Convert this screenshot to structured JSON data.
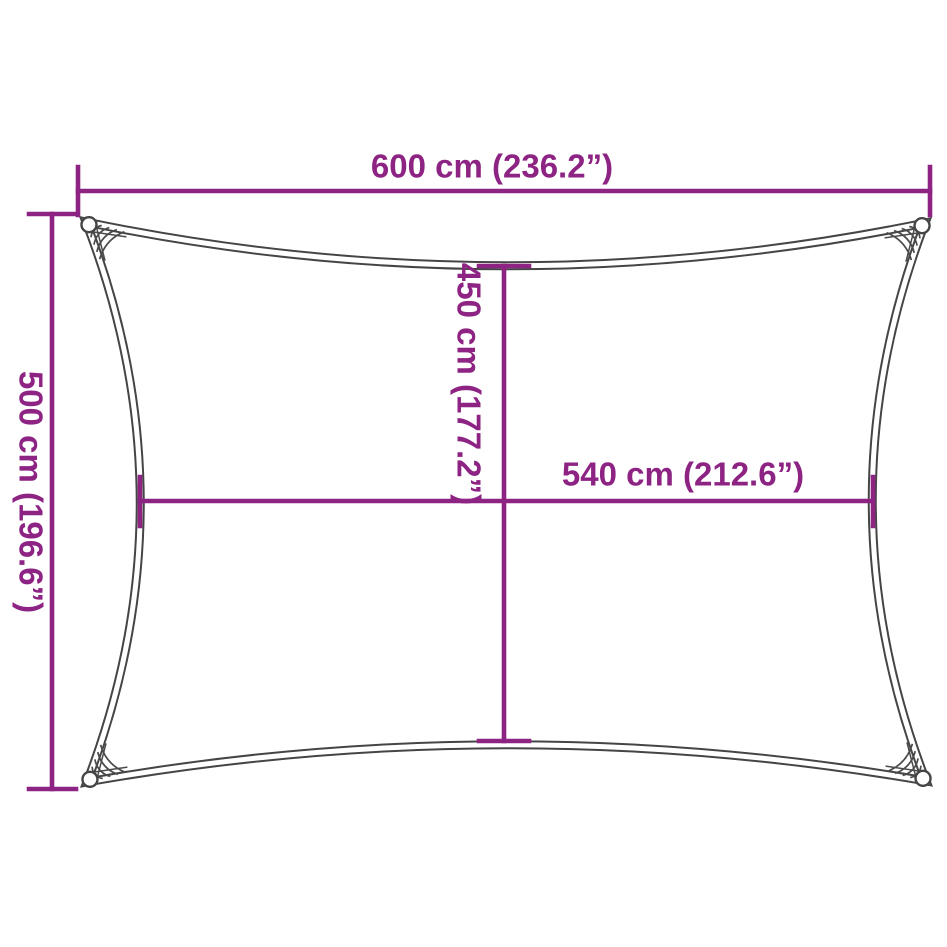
{
  "colors": {
    "dimension": "#8d2383",
    "outline": "#454545",
    "lacing": "#4a4a4a",
    "background": "#ffffff"
  },
  "dimensions": {
    "top_width": {
      "label": "600 cm (236.2”)",
      "cm": 600,
      "inches": 236.2
    },
    "left_height": {
      "label": "500 cm (196.6”)",
      "cm": 500,
      "inches": 196.6
    },
    "center_height": {
      "label": "450 cm (177.2”)",
      "cm": 450,
      "inches": 177.2
    },
    "center_width": {
      "label": "540 cm (212.6”)",
      "cm": 540,
      "inches": 212.6
    }
  }
}
